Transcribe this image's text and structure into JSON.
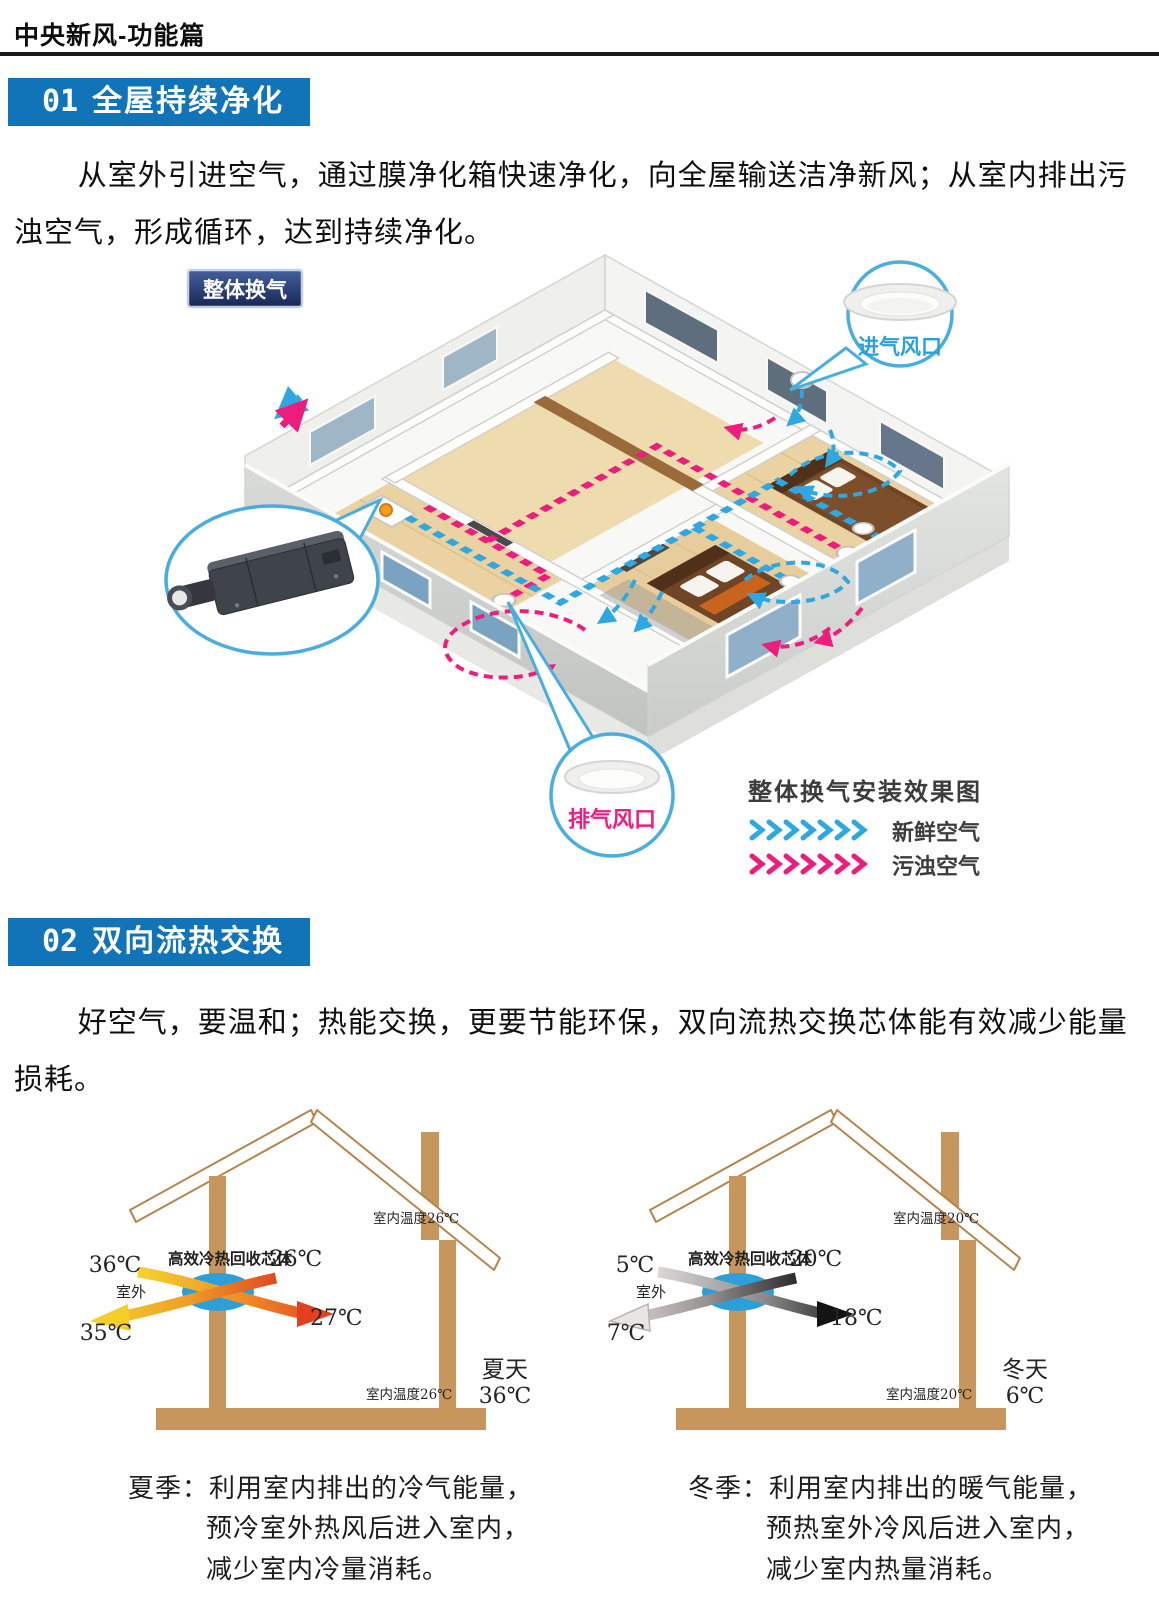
{
  "header": {
    "title": "中央新风-功能篇"
  },
  "colors": {
    "banner_blue": "#1173b8",
    "fresh_blue": "#2fa8e1",
    "polluted_pink": "#ec1d7c",
    "core_blue": "#2d9fd8",
    "wood_tan": "#c6965c",
    "tag_navy": "#182754"
  },
  "section1": {
    "number": "01",
    "title": "全屋持续净化",
    "paragraph": "从室外引进空气，通过膜净化箱快速净化，向全屋输送洁净新风；从室内排出污浊空气，形成循环，达到持续净化。",
    "figure": {
      "tag": "整体换气",
      "intake_vent": "进气风口",
      "exhaust_vent": "排气风口",
      "legend_title": "整体换气安装效果图",
      "legend_fresh": "新鲜空气",
      "legend_polluted": "污浊空气"
    }
  },
  "section2": {
    "number": "02",
    "title": "双向流热交换",
    "paragraph": "好空气，要温和；热能交换，更要节能环保，双向流热交换芯体能有效减少能量损耗。",
    "summer": {
      "core_label": "高效冷热回收芯体",
      "outdoor_label": "室外",
      "outdoor_in_temp": "36℃",
      "exhaust_out_temp": "35℃",
      "indoor_return_temp": "26℃",
      "supply_in_temp": "27℃",
      "indoor_temp_roof": "室内温度26℃",
      "indoor_temp_floor": "室内温度26℃",
      "season": "夏天",
      "season_temp": "36℃",
      "caption": {
        "line1": "夏季：利用室内排出的冷气能量，",
        "line2": "预冷室外热风后进入室内，",
        "line3": "减少室内冷量消耗。"
      }
    },
    "winter": {
      "core_label": "高效冷热回收芯体",
      "outdoor_label": "室外",
      "outdoor_in_temp": "5℃",
      "exhaust_out_temp": "7℃",
      "indoor_return_temp": "20℃",
      "supply_in_temp": "18℃",
      "indoor_temp_roof": "室内温度20℃",
      "indoor_temp_floor": "室内温度20℃",
      "season": "冬天",
      "season_temp": "6℃",
      "caption": {
        "line1": "冬季：利用室内排出的暖气能量，",
        "line2": "预热室外冷风后进入室内，",
        "line3": "减少室内热量消耗。"
      }
    }
  }
}
